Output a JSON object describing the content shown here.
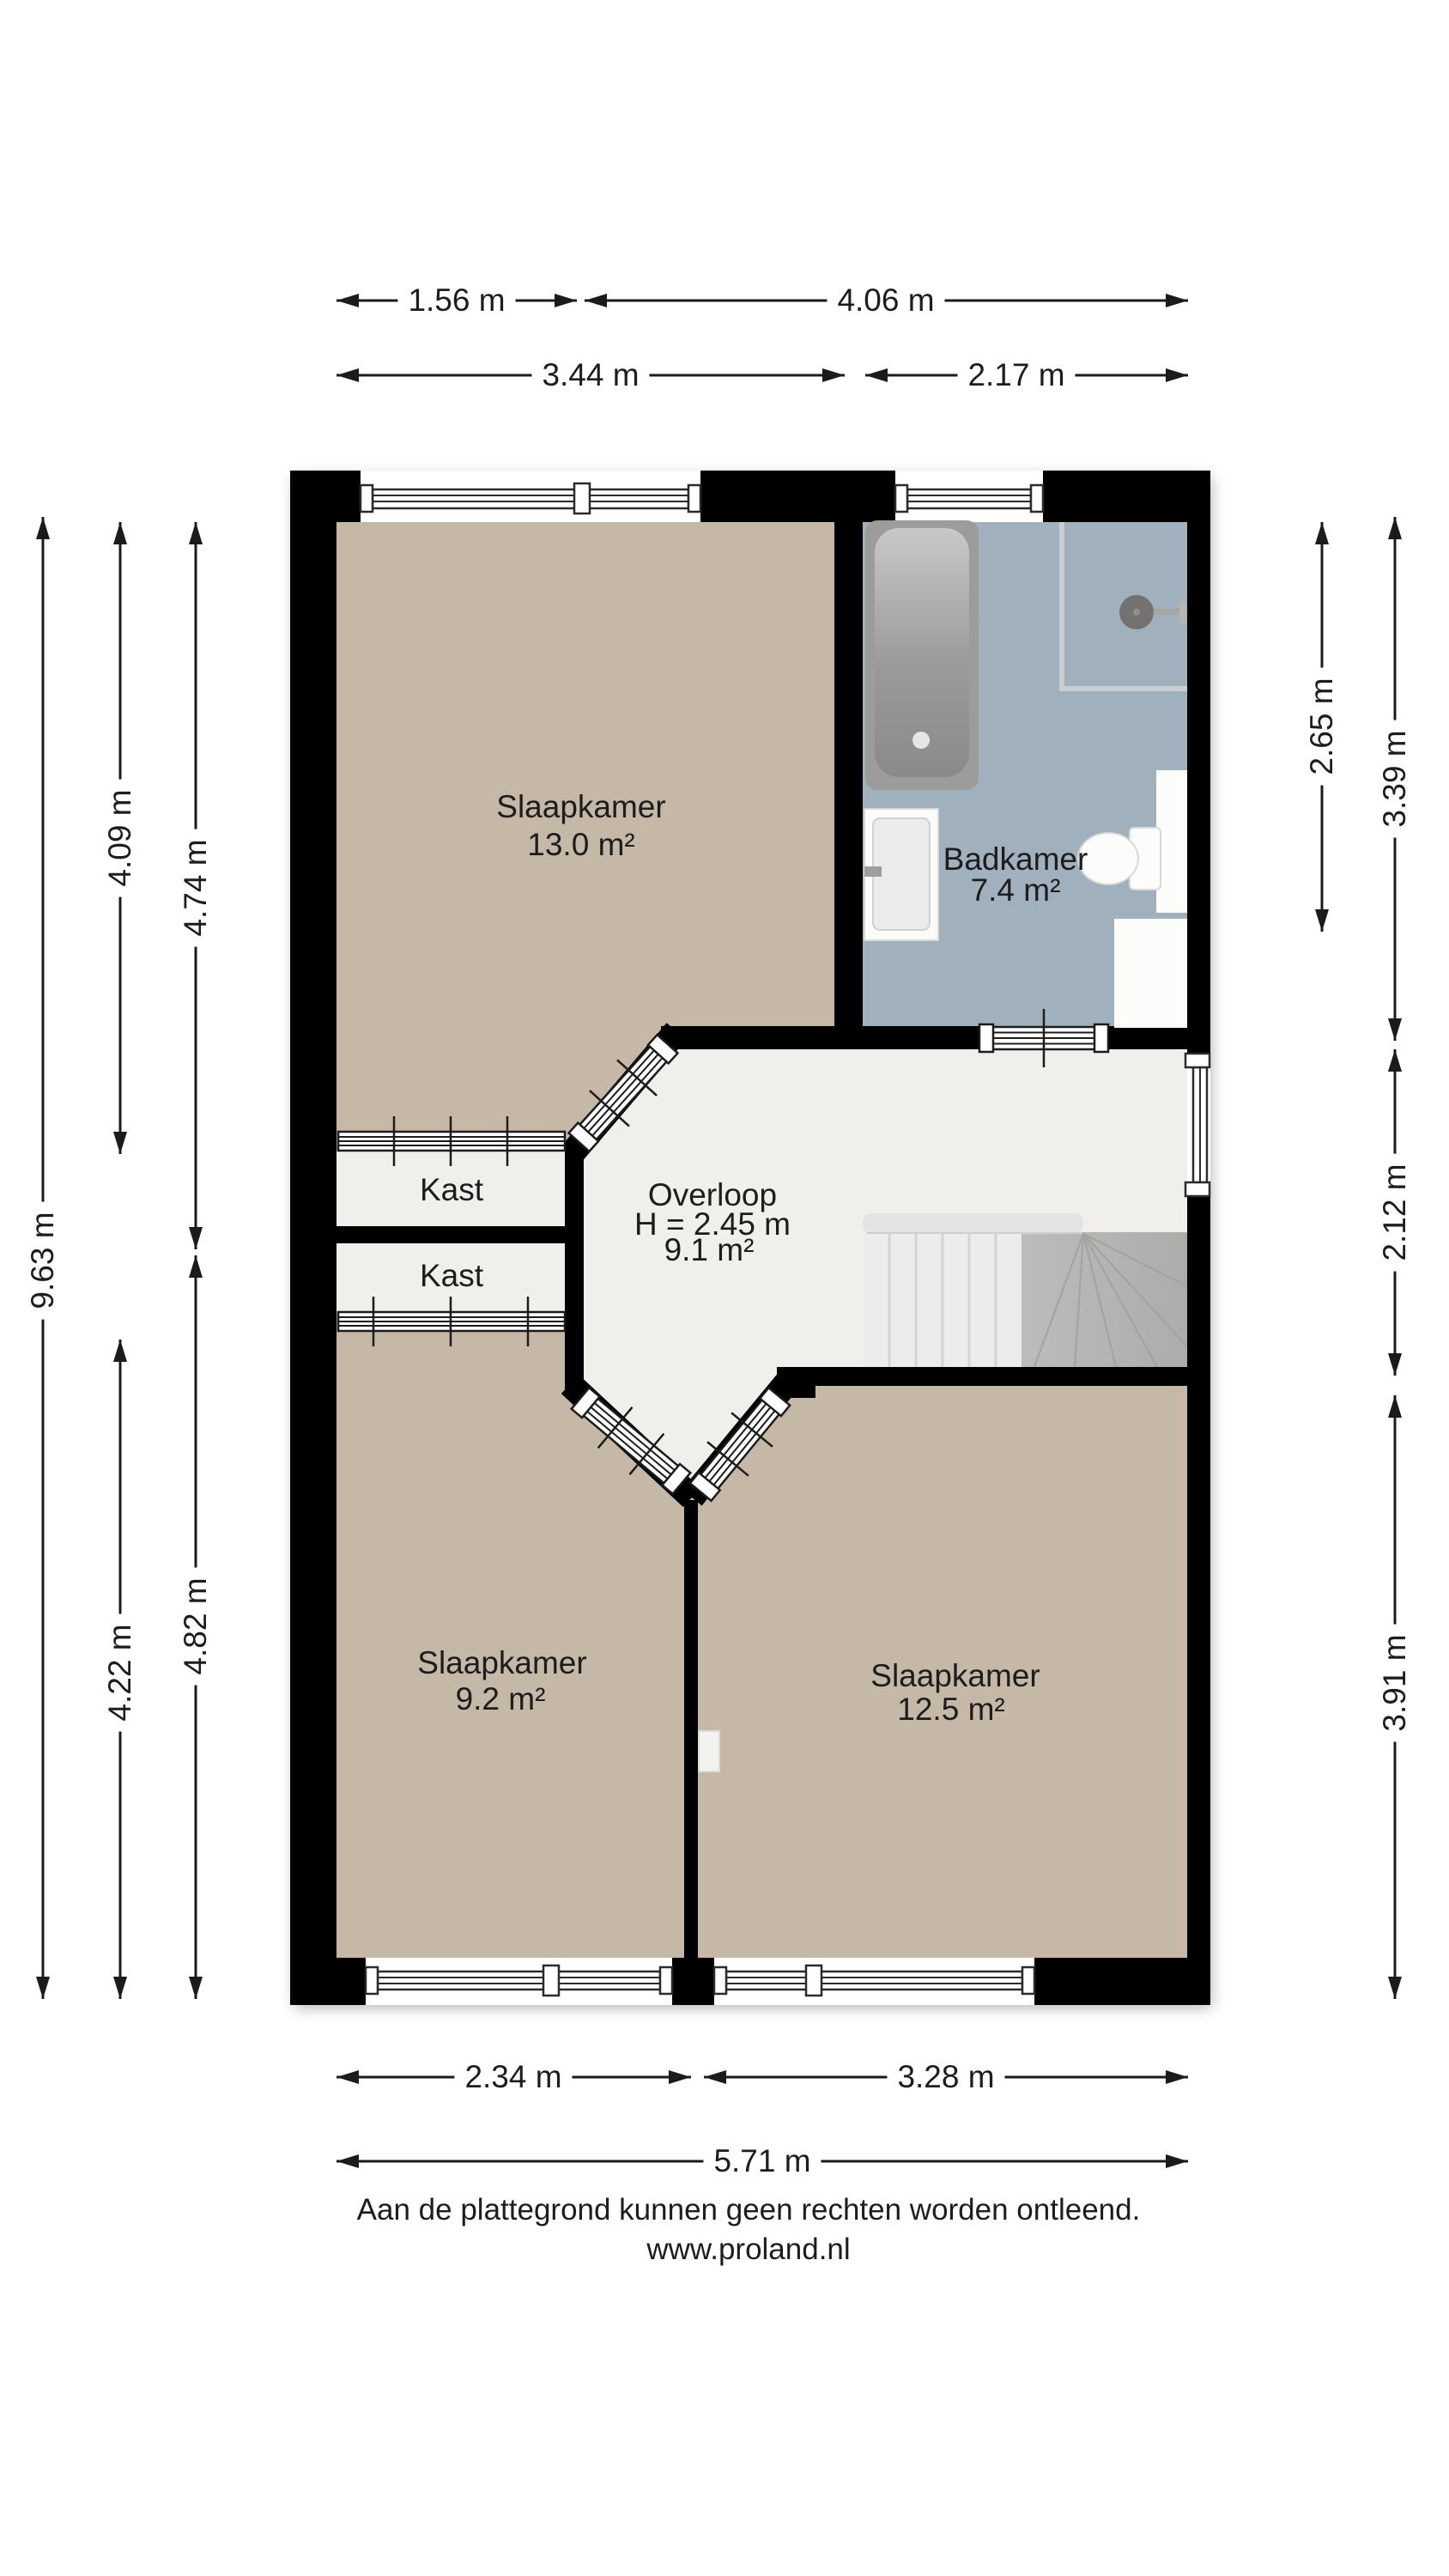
{
  "document": {
    "type": "floor-plan",
    "footer_disclaimer": "Aan de plattegrond kunnen geen rechten worden ontleend.",
    "footer_website": "www.proland.nl"
  },
  "rooms": {
    "bedroom_top_left": {
      "name": "Slaapkamer",
      "area": "13.0 m²"
    },
    "bathroom": {
      "name": "Badkamer",
      "area": "7.4 m²"
    },
    "closet_top": {
      "name": "Kast"
    },
    "closet_bottom": {
      "name": "Kast"
    },
    "landing": {
      "name": "Overloop",
      "ceiling_height": "H = 2.45 m",
      "area": "9.1 m²"
    },
    "bedroom_bottom_left": {
      "name": "Slaapkamer",
      "area": "9.2 m²"
    },
    "bedroom_bottom_right": {
      "name": "Slaapkamer",
      "area": "12.5 m²"
    }
  },
  "dimensions": {
    "top_row_1": [
      {
        "label": "1.56 m"
      },
      {
        "label": "4.06 m"
      }
    ],
    "top_row_2": [
      {
        "label": "3.44 m"
      },
      {
        "label": "2.17 m"
      }
    ],
    "left_outer": {
      "label": "9.63 m"
    },
    "left_middle": [
      {
        "label": "4.09 m"
      },
      {
        "label": "4.22 m"
      }
    ],
    "left_inner": [
      {
        "label": "4.74 m"
      },
      {
        "label": "4.82 m"
      }
    ],
    "right_inner": {
      "label": "2.65 m"
    },
    "right_outer": [
      {
        "label": "3.39 m"
      },
      {
        "label": "2.12 m"
      },
      {
        "label": "3.91 m"
      }
    ],
    "bottom_row_1": [
      {
        "label": "2.34 m"
      },
      {
        "label": "3.28 m"
      }
    ],
    "bottom_row_2": [
      {
        "label": "5.71 m"
      }
    ]
  },
  "colors": {
    "wall": "#000000",
    "bedroom_floor": "#c6b8a7",
    "bathroom_floor": "#a0b1bd",
    "landing_floor": "#f0efeb",
    "stair_winder": "#b5b5b3",
    "fixture_gray": "#9c9c9a",
    "text": "#1d1d1d"
  }
}
